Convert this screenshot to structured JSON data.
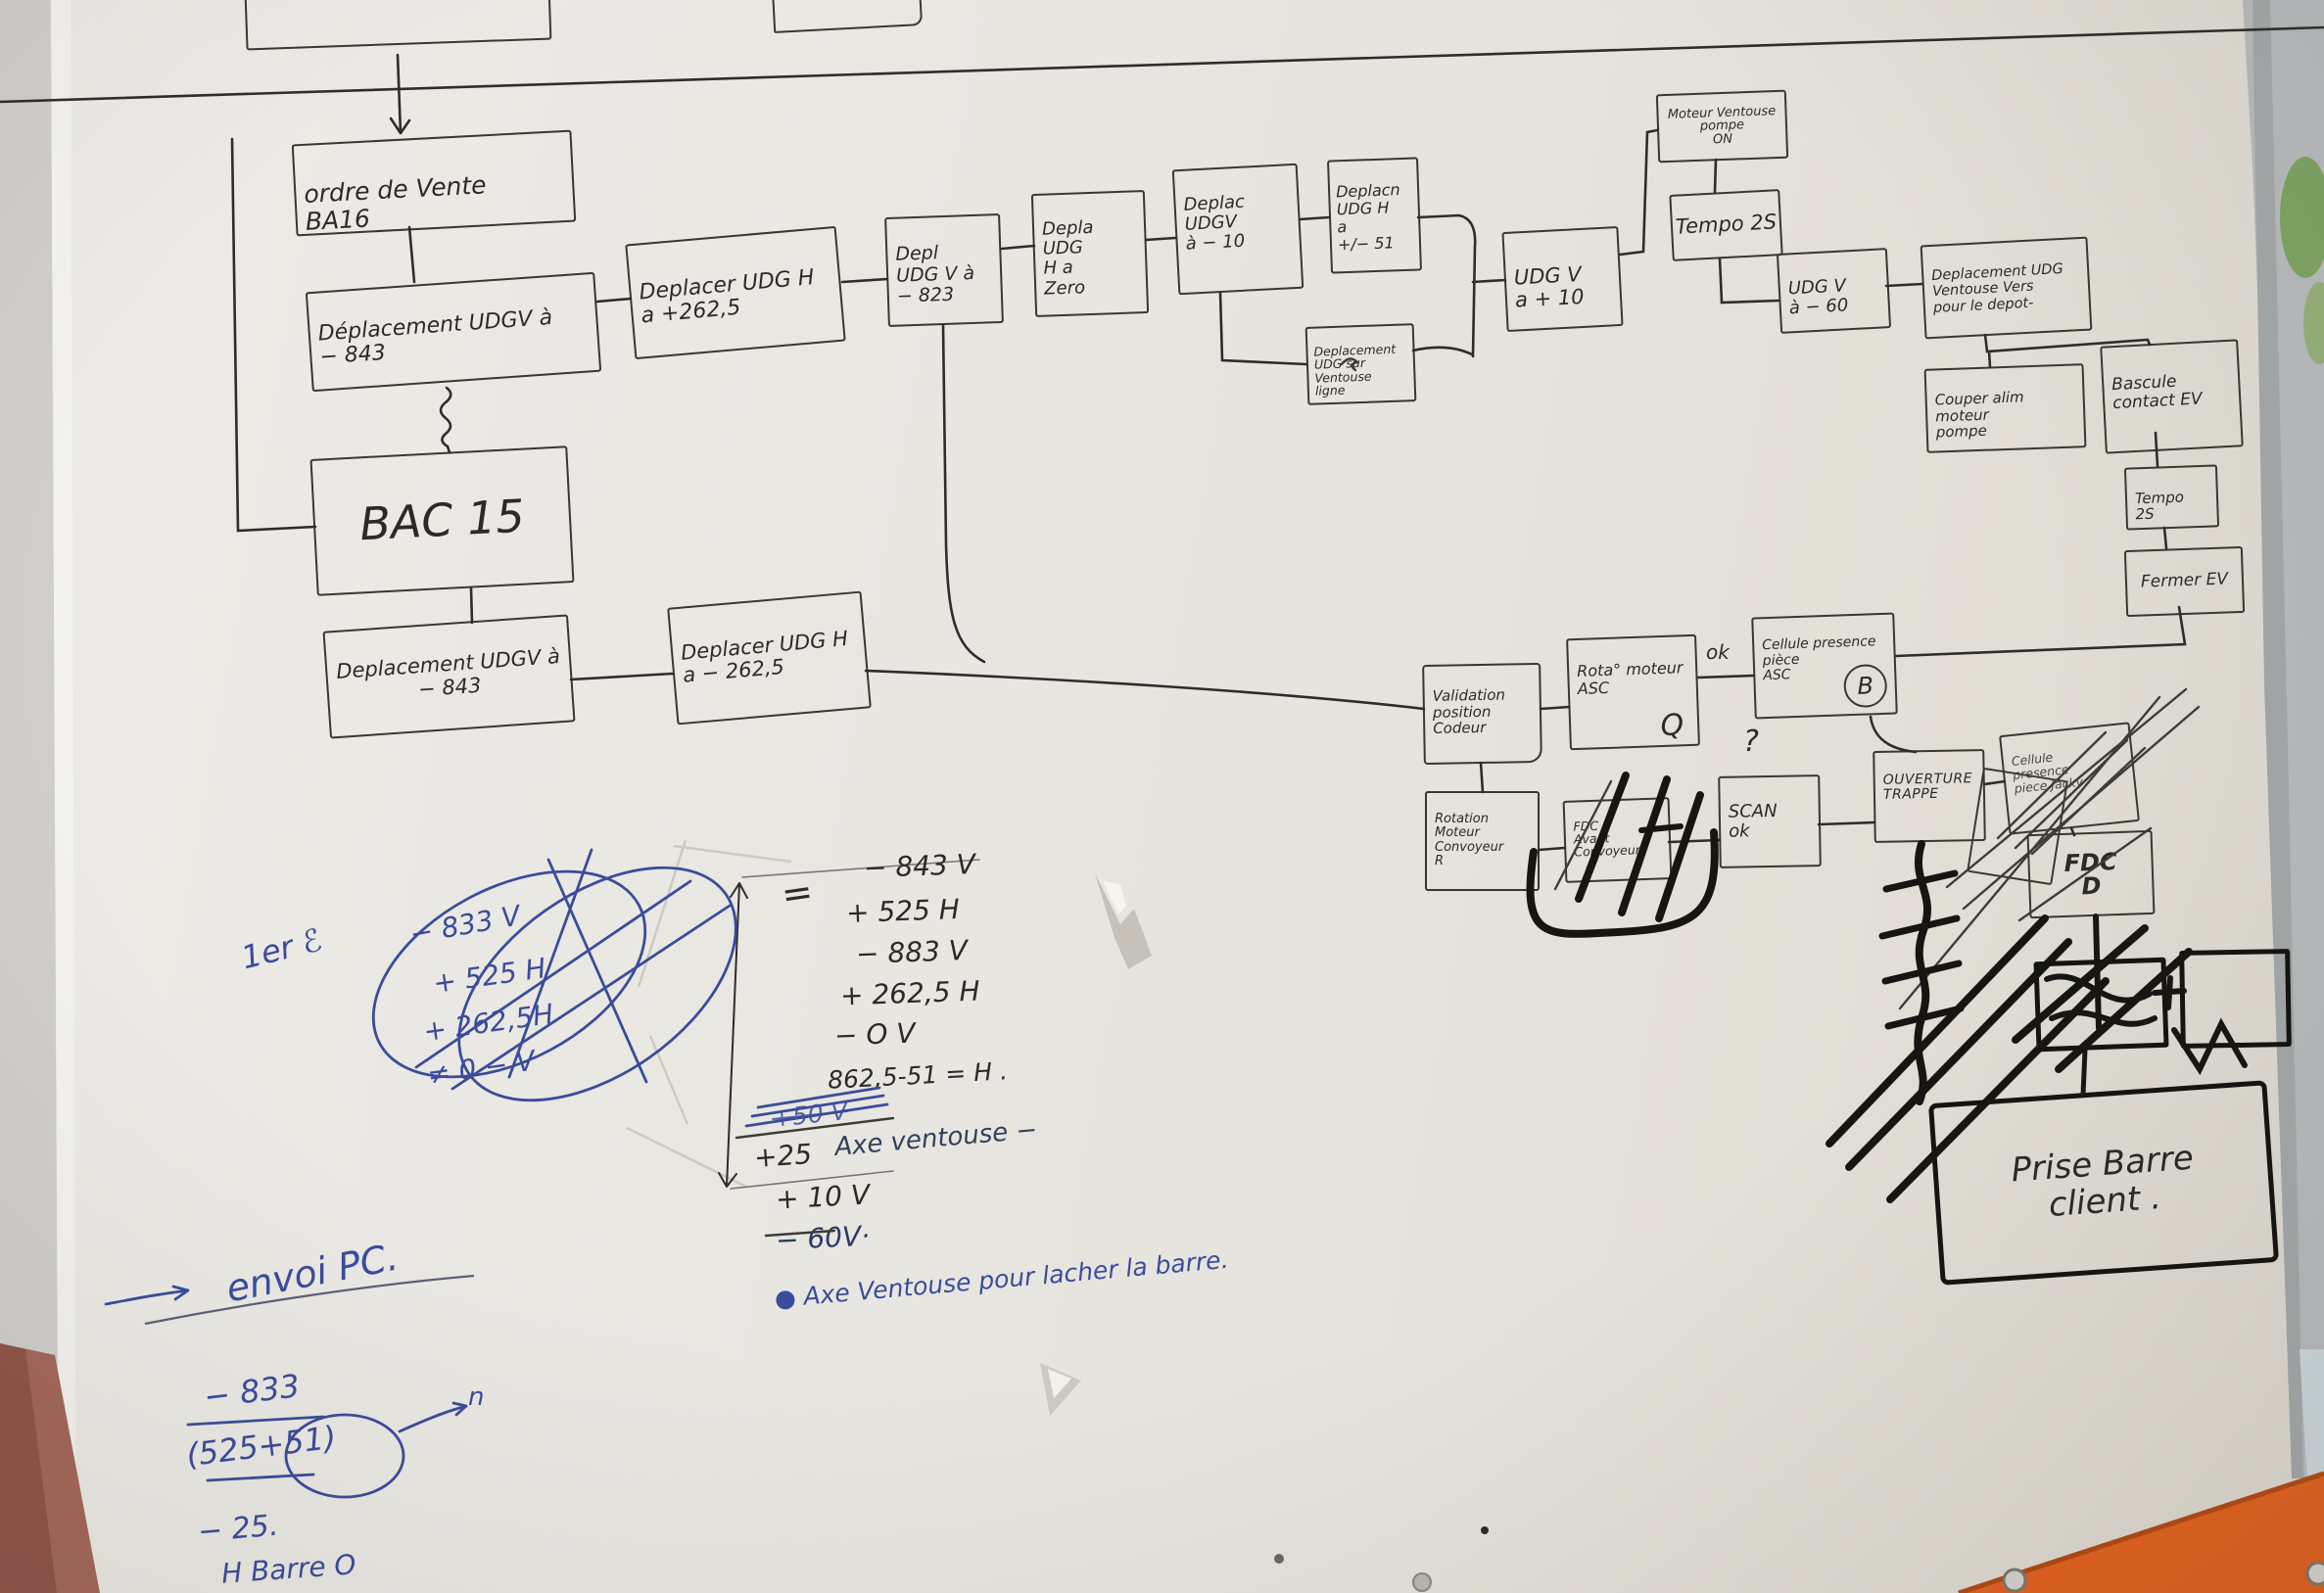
{
  "scene": {
    "description": "photo of hand-drawn machine sequence flowchart on flipchart paper",
    "paper_color": "#e9e7e2",
    "ink_color": "#2f2d29",
    "blue_pen_color": "#3a4c9b",
    "orange_panel_color": "#e2611f",
    "wood_edge_color": "#a2675a",
    "wall_strip_color": "#b7bbbc",
    "foliage_color": "#7da463"
  },
  "nodes": [
    {
      "id": "ordre-de-vente",
      "label": "ordre de Vente\nBA16"
    },
    {
      "id": "depl-udgv-843-top",
      "label": "Déplacement UDGV à\n− 843"
    },
    {
      "id": "depl-udgh-plus-262",
      "label": "Deplacer UDG H\na +262,5"
    },
    {
      "id": "depl-udgv-823",
      "label": "Depl\nUDG V à\n− 823"
    },
    {
      "id": "depl-udgh-zero",
      "label": "Depla UDG\nH a\nZero"
    },
    {
      "id": "depl-udgv-10",
      "label": "Deplac UDGV\nà − 10"
    },
    {
      "id": "depl-udgh-51",
      "label": "Deplacn\nUDG H\na\n+/− 51"
    },
    {
      "id": "depl-udg-ventouse-ligne",
      "label": "Deplacement\nUDG sur\nVentouse\nligne"
    },
    {
      "id": "udgv-plus-10",
      "label": "UDG V\na + 10"
    },
    {
      "id": "moteur-ventouse-pompe-on",
      "label": "Moteur Ventouse\npompe\nON"
    },
    {
      "id": "tempo-2s-top",
      "label": "Tempo 2S"
    },
    {
      "id": "udgv-minus-60",
      "label": "UDG V\nà − 60"
    },
    {
      "id": "depl-udg-ventouse-depot",
      "label": "Deplacement UDG\nVentouse Vers\npour le depot-"
    },
    {
      "id": "couper-alim-pompe",
      "label": "Couper alim moteur\npompe"
    },
    {
      "id": "bascule-contact-ev",
      "label": "Bascule\ncontact EV"
    },
    {
      "id": "tempo-2s-right",
      "label": "Tempo\n2S"
    },
    {
      "id": "fermer-ev",
      "label": "Fermer EV"
    },
    {
      "id": "bac-15",
      "label": "BAC 15"
    },
    {
      "id": "depl-udgv-843-row2",
      "label": "Deplacement UDGV à\n− 843"
    },
    {
      "id": "depl-udgh-minus-262",
      "label": "Deplacer UDG H\na − 262,5"
    },
    {
      "id": "validation-position-codeur",
      "label": "Validation\nposition\nCodeur"
    },
    {
      "id": "rotation-moteur-asc",
      "label": "Rota° moteur\nASC"
    },
    {
      "id": "cellule-presence-piece-asc",
      "label": "Cellule presence\npièce\nASC"
    },
    {
      "id": "rotation-moteur-convoyeur",
      "label": "Rotation\nMoteur Convoyeur\nR"
    },
    {
      "id": "fdc-avant-convoyeur",
      "label": "FDC\nAvant\nConvoyeur"
    },
    {
      "id": "scan-ok",
      "label": "SCAN\nok"
    },
    {
      "id": "ouverture-trappe",
      "label": "OUVERTURE\nTRAPPE"
    },
    {
      "id": "cellule-presence-piece-crossed",
      "label": "Cellule\npresence\npiece Jacky"
    },
    {
      "id": "fdc-d",
      "label": "FDC\nD"
    },
    {
      "id": "prise-barre-client",
      "label": "Prise Barre\nclient ."
    }
  ],
  "labels": {
    "ok": "ok",
    "question": "?",
    "b": "B",
    "q": "Q",
    "n": "n",
    "equals": "=",
    "first_try": "1er ℰ"
  },
  "calc": {
    "rows": [
      "− 843 V",
      "+ 525 H",
      "− 883 V",
      "+ 262,5 H",
      "− O V",
      "862,5-51 = H ."
    ],
    "struck": "+50 V",
    "plus25": "+25",
    "axe_note": "Axe ventouse −",
    "plus10": "+ 10 V",
    "minus60": "− 60V·",
    "release_note": "● Axe Ventouse pour lacher la barre."
  },
  "crossed_blue": {
    "header": "1er ℰ",
    "rows": [
      "− 833 V",
      "+ 525 H",
      "+ 262,5H",
      "≠ 0 − V"
    ]
  },
  "envoi": {
    "title": "envoi PC.",
    "rows": [
      "− 833",
      "(525+51)",
      "− 25.",
      "H Barre O"
    ],
    "exponent": "n"
  }
}
